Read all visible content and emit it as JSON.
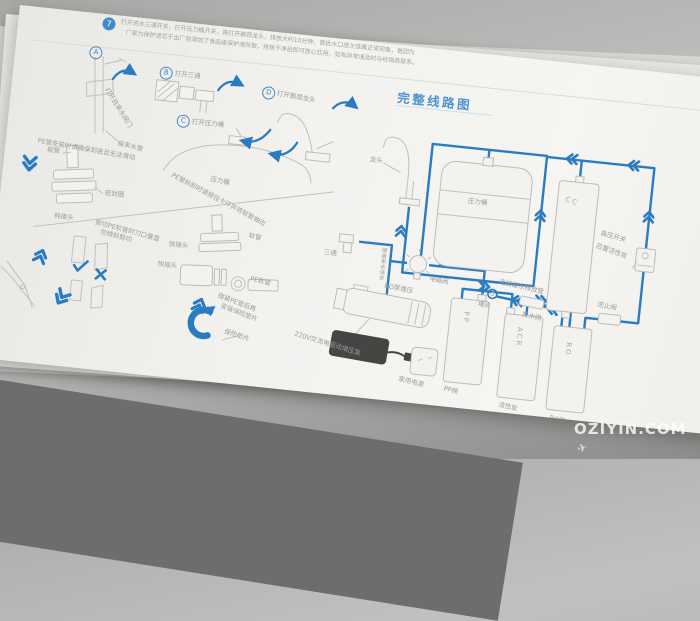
{
  "intro": {
    "badge": "7",
    "line1": "打开进水三通开关，打开压力桶开关，再打开鹅颈龙头，排放大约10分钟，首批水口感欠佳属正常现象，是因为",
    "line2": "厂家为保护滤芯于出厂前添加了食品级保护液所致，排放干净后即可放心饮用，如有异常请及时与经销商联系。"
  },
  "steps": [
    {
      "key": "A",
      "label": "打开自来水阀门"
    },
    {
      "key": "B",
      "label": "打开三通"
    },
    {
      "key": "C",
      "label": "打开压力桶"
    },
    {
      "key": "D",
      "label": "打开鹅颈龙头"
    }
  ],
  "left": {
    "tap_pipe": "自来水管",
    "tank": "压力桶"
  },
  "pe_install": {
    "title": "PE管安装时请确保到底且无法滑动",
    "hose": "软管",
    "seal": "密封圈",
    "adapter": "转接头",
    "cut1": "剪切PE软管时刀口垂直",
    "cut2": "勿倾斜剪切"
  },
  "pe_remove": {
    "title": "PE管拆卸时请按住卡环并将软管抽出",
    "hose": "软管",
    "quick1": "快接头",
    "quick2": "快接头",
    "pe_hose": "PE软管",
    "clip1": "插紧PE管后再",
    "clip2": "安装保险垫片",
    "gasket": "保险垫片"
  },
  "diagram": {
    "title": "完整线路图",
    "faucet": "龙头",
    "tank": "压力桶",
    "cc": "CC",
    "cc_name": "后置活性炭",
    "hp_switch": "高压开关",
    "check_valve": "逆止阀",
    "tee": "三通",
    "inlet": "接自来水进水",
    "solenoid": "电磁阀",
    "pump": "RO泵增压",
    "power": "220V交流电驱动增压泵",
    "outlet": "家用电源",
    "pp": "PP",
    "pp_name": "PP棉",
    "acr": "ACR",
    "acr_name": "活性炭",
    "ro": "RO",
    "ro_name": "RO膜",
    "waste_valve": "废水阀",
    "waste_note": "连接废水排放管",
    "drain": "堵头"
  },
  "watermark": {
    "text": "OZIYIN.COM",
    "icon": "✈"
  },
  "colors": {
    "pipe_blue": "#2a7cc2",
    "title_blue": "#4e94d0",
    "paper": "#f3f2ef",
    "line_gray": "#c1c0be"
  }
}
